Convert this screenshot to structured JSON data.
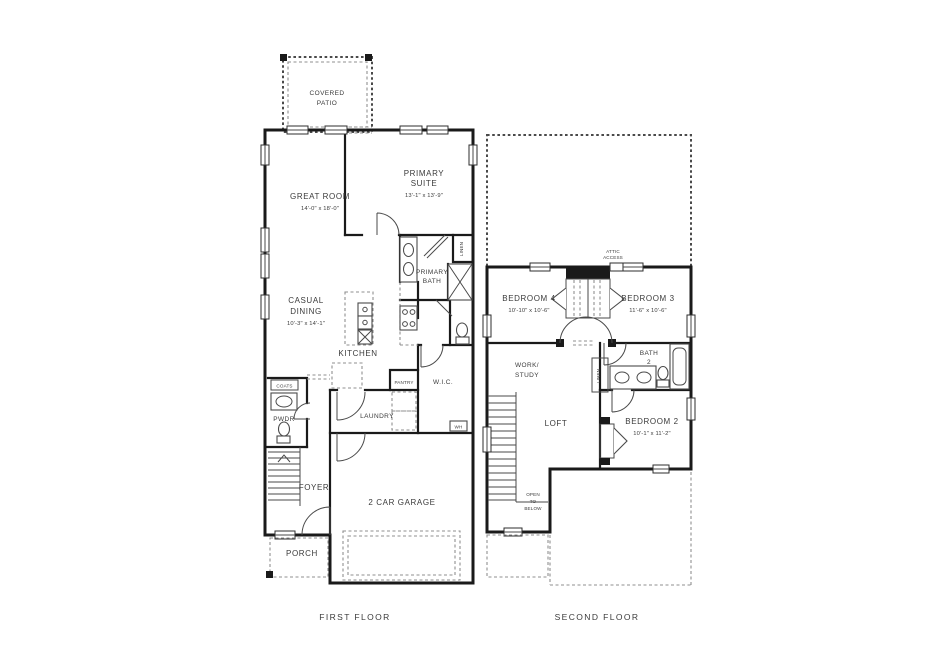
{
  "colors": {
    "background": "#ffffff",
    "wall": "#1a1a1a",
    "line": "#4a4a4a",
    "dashed": "#8f8f8f",
    "text": "#3b3b3b"
  },
  "first_floor": {
    "caption": "FIRST FLOOR",
    "rooms": {
      "covered_patio": {
        "lines": [
          "COVERED",
          "PATIO"
        ]
      },
      "great_room": {
        "name": "GREAT ROOM",
        "dims": "14'-0\" x 18'-0\""
      },
      "primary_suite": {
        "lines": [
          "PRIMARY",
          "SUITE"
        ],
        "dims": "13'-1\" x 13'-9\""
      },
      "primary_bath": {
        "lines": [
          "PRIMARY",
          "BATH"
        ]
      },
      "casual_dining": {
        "lines": [
          "CASUAL",
          "DINING"
        ],
        "dims": "10'-3\" x 14'-1\""
      },
      "kitchen": {
        "name": "KITCHEN"
      },
      "pantry": {
        "name": "PANTRY"
      },
      "laundry": {
        "name": "LAUNDRY"
      },
      "wic": {
        "name": "W.I.C."
      },
      "coats": {
        "name": "COATS"
      },
      "powder": {
        "name": "PWDR"
      },
      "foyer": {
        "name": "FOYER"
      },
      "porch": {
        "name": "PORCH"
      },
      "garage": {
        "name": "2 CAR GARAGE"
      },
      "linen": {
        "name": "LINEN"
      },
      "water_heater": {
        "name": "WH"
      }
    }
  },
  "second_floor": {
    "caption": "SECOND FLOOR",
    "rooms": {
      "bedroom4": {
        "name": "BEDROOM 4",
        "dims": "10'-10\" x 10'-6\""
      },
      "bedroom3": {
        "name": "BEDROOM 3",
        "dims": "11'-6\" x 10'-6\""
      },
      "bedroom2": {
        "name": "BEDROOM 2",
        "dims": "10'-1\" x 11'-2\""
      },
      "bath2": {
        "lines": [
          "BATH",
          "2"
        ]
      },
      "work_study": {
        "lines": [
          "WORK/",
          "STUDY"
        ]
      },
      "loft": {
        "name": "LOFT"
      },
      "open_to_below": {
        "lines": [
          "OPEN",
          "TO",
          "BELOW"
        ]
      },
      "attic_access": {
        "lines": [
          "ATTIC",
          "ACCESS"
        ]
      },
      "linen": {
        "name": "LINEN"
      }
    }
  }
}
